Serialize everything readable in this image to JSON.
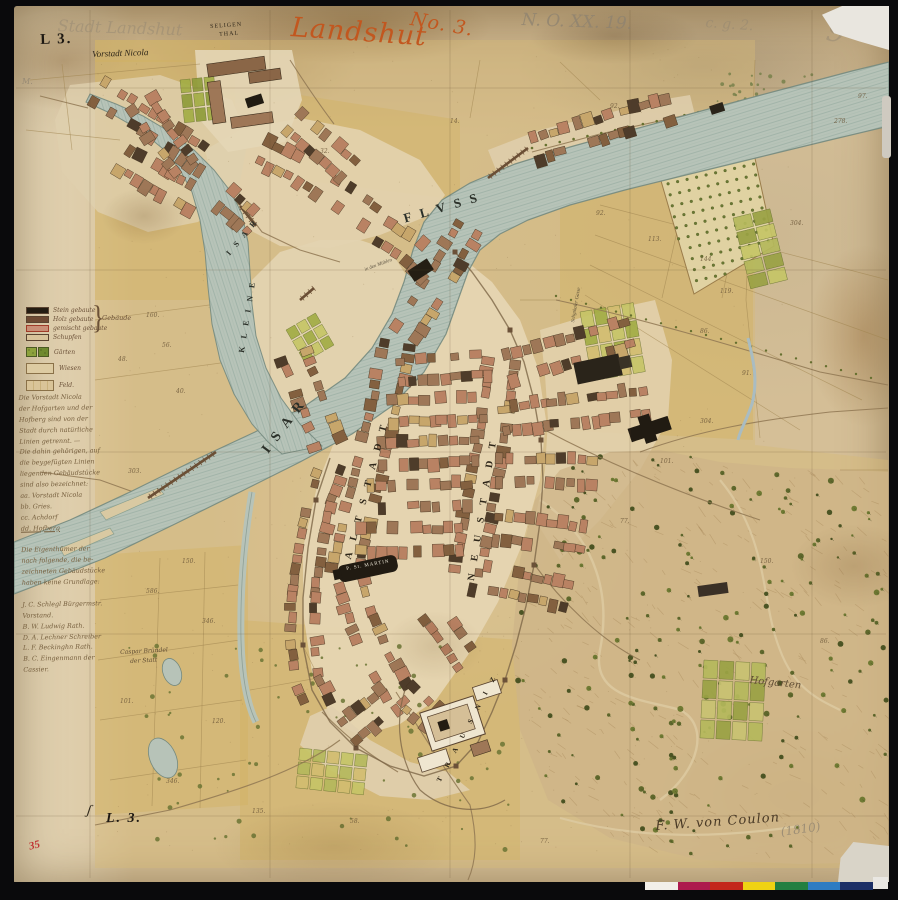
{
  "document": {
    "type": "historic-city-map-scan",
    "title_script": "Landshut",
    "sheet_no": "No. 3.",
    "stamp_top": "L 3.",
    "stamp_bottom": "L. 3.",
    "archive_pencil": "N. O. XX. 19.",
    "pencil_faint_top": "Stadt Landshut",
    "red_margin_number": "35",
    "signature": "F. W. von Coulon",
    "signature_year": "(1810)"
  },
  "labels": [
    {
      "name": "stamp-L3-top",
      "t": "L 3.",
      "x": 40,
      "y": 33,
      "size": 15,
      "rot": -2,
      "cls": "stamp"
    },
    {
      "name": "pencil-stadt-landshut",
      "t": "Stadt Landshut",
      "x": 58,
      "y": 18,
      "size": 16,
      "rot": 2,
      "cls": "pencil faint"
    },
    {
      "name": "red-landshut",
      "t": "Landshut",
      "x": 292,
      "y": 14,
      "size": 27,
      "rot": 4,
      "cls": "redscript"
    },
    {
      "name": "red-no3",
      "t": "No. 3.",
      "x": 412,
      "y": 10,
      "size": 19,
      "rot": 10,
      "cls": "redscript"
    },
    {
      "name": "pencil-archive-no",
      "t": "N. O. XX. 19.",
      "x": 522,
      "y": 12,
      "size": 17,
      "rot": 2,
      "cls": "pencil"
    },
    {
      "name": "pencil-scribble",
      "t": "c. g. 2.",
      "x": 706,
      "y": 16,
      "size": 14,
      "rot": 4,
      "cls": "pencil faint"
    },
    {
      "name": "pencil-flourish",
      "t": "9",
      "x": 830,
      "y": 16,
      "size": 30,
      "rot": 12,
      "cls": "pencil faint"
    },
    {
      "name": "pencil-m",
      "t": "M.",
      "x": 22,
      "y": 78,
      "size": 8,
      "rot": 0,
      "cls": "pencil"
    },
    {
      "name": "vorstadt-nicola-label",
      "t": "Vorstadt Nicola",
      "x": 92,
      "y": 50,
      "size": 9,
      "rot": -2,
      "cls": "inkital"
    },
    {
      "name": "seligenthal-label-1",
      "t": "SELIGEN",
      "x": 210,
      "y": 24,
      "size": 6,
      "rot": -4,
      "cls": "smallcaps"
    },
    {
      "name": "seligenthal-label-2",
      "t": "THAL",
      "x": 219,
      "y": 32,
      "size": 6,
      "rot": -4,
      "cls": "smallcaps"
    },
    {
      "name": "river-label-fluss",
      "t": "F L V S S",
      "x": 402,
      "y": 212,
      "size": 13,
      "rot": -16,
      "cls": "river-label"
    },
    {
      "name": "river-label-isar-main",
      "t": "I S A R",
      "x": 260,
      "y": 448,
      "size": 14,
      "rot": -53,
      "cls": "river-label"
    },
    {
      "name": "river-label-kleine",
      "t": "K L E I N E",
      "x": 238,
      "y": 352,
      "size": 8,
      "rot": -81,
      "cls": "river-label"
    },
    {
      "name": "river-label-isar-small",
      "t": "I S A R",
      "x": 225,
      "y": 252,
      "size": 8,
      "rot": -50,
      "cls": "river-label"
    },
    {
      "name": "street-label-altstadt",
      "t": "A L T S T A D T",
      "x": 344,
      "y": 558,
      "size": 10,
      "rot": -75,
      "cls": "street-label"
    },
    {
      "name": "street-label-neustadt",
      "t": "N E U S T A D T",
      "x": 467,
      "y": 580,
      "size": 10,
      "rot": -81,
      "cls": "street-label"
    },
    {
      "name": "church-label-st-martin",
      "t": "P. St. MARTIN",
      "x": 346,
      "y": 567,
      "size": 5,
      "rot": -10,
      "cls": "church-label"
    },
    {
      "name": "castle-label-trausnitz",
      "t": "T R A U S N I Z",
      "x": 436,
      "y": 780,
      "size": 7,
      "rot": -62,
      "cls": "street-label"
    },
    {
      "name": "hofgarten-label",
      "t": "Hofgarten",
      "x": 750,
      "y": 676,
      "size": 10,
      "rot": 6,
      "cls": "script"
    },
    {
      "name": "gasse-label",
      "t": "Seligthaler Gasse",
      "x": 571,
      "y": 322,
      "size": 5,
      "rot": -80,
      "cls": "tiny-ink"
    },
    {
      "name": "muehlen-label",
      "t": "in den Mühlen",
      "x": 364,
      "y": 268,
      "size": 5,
      "rot": -20,
      "cls": "tiny-ink"
    },
    {
      "name": "owner-note-1",
      "t": "Caspar Bründel",
      "x": 120,
      "y": 650,
      "size": 6,
      "rot": -3,
      "cls": "script"
    },
    {
      "name": "owner-note-2",
      "t": "der Statt",
      "x": 130,
      "y": 659,
      "size": 6,
      "rot": -3,
      "cls": "script"
    },
    {
      "name": "stamp-L3-bottom",
      "t": "L. 3.",
      "x": 106,
      "y": 812,
      "size": 14,
      "rot": 0,
      "cls": "stamp italic"
    },
    {
      "name": "bracket-mark",
      "t": "ʃ",
      "x": 88,
      "y": 804,
      "size": 14,
      "rot": 8,
      "cls": "inkital"
    },
    {
      "name": "red-margin-35",
      "t": "35",
      "x": 28,
      "y": 842,
      "size": 11,
      "rot": -14,
      "cls": "rednum"
    },
    {
      "name": "signature-coulon",
      "t": "F. W. von Coulon",
      "x": 655,
      "y": 820,
      "size": 13,
      "rot": -4,
      "cls": "signature"
    },
    {
      "name": "signature-year",
      "t": "(1810)",
      "x": 780,
      "y": 826,
      "size": 12,
      "rot": -8,
      "cls": "pencil"
    }
  ],
  "legend": {
    "rows": [
      {
        "label": "Stein gebaute",
        "color": "#241c12"
      },
      {
        "label": "Holz gebaute",
        "color": "#6e4a33"
      },
      {
        "label": "gemischt gebaute",
        "color": "#c98f76"
      },
      {
        "label": "Schupfen",
        "color": "#d8c39a"
      }
    ],
    "brace_label": "Gebäude",
    "garden_label": "Gärten",
    "wiesen_label": "Wiesen",
    "feld_label": "Feld."
  },
  "note_lines": [
    {
      "t": "Die Vorstadt Nicola"
    },
    {
      "t": "der Hofgarten und der"
    },
    {
      "t": "Hofberg sind von der"
    },
    {
      "t": "Stadt durch natürliche"
    },
    {
      "t": "Linien getrennt. —"
    },
    {
      "t": "Die dahin gehörigen, auf"
    },
    {
      "t": "die beygefügten Linien"
    },
    {
      "t": "liegenden Gebäudstücke"
    },
    {
      "t": "sind also bezeichnet:"
    },
    {
      "t": "aa. Vorstadt Nicola"
    },
    {
      "t": "bb. Gries."
    },
    {
      "t": "cc. Achdorf"
    },
    {
      "t": "dd. Hofberg",
      "u": true
    },
    {
      "t": ""
    },
    {
      "t": "Die Eigenthümer der"
    },
    {
      "t": "nach folgende, die be-"
    },
    {
      "t": "zeichneten Gebäudstücke"
    },
    {
      "t": "haben keine Grundlage:"
    },
    {
      "t": ""
    },
    {
      "t": "J. C. Schlegl Bürgermstr."
    },
    {
      "t": "Vorstand."
    },
    {
      "t": "B. W. Ludwig Rath."
    },
    {
      "t": "D. A. Lechner Schreiber"
    },
    {
      "t": "L. F. Beckinghn Rath."
    },
    {
      "t": "B. C. Eingenmann der"
    },
    {
      "t": "Cassier."
    }
  ],
  "field_numbers": [
    {
      "x": 146,
      "y": 312,
      "t": "160."
    },
    {
      "x": 118,
      "y": 356,
      "t": "48."
    },
    {
      "x": 162,
      "y": 342,
      "t": "56."
    },
    {
      "x": 176,
      "y": 388,
      "t": "40."
    },
    {
      "x": 128,
      "y": 468,
      "t": "303."
    },
    {
      "x": 182,
      "y": 558,
      "t": "150."
    },
    {
      "x": 146,
      "y": 588,
      "t": "586."
    },
    {
      "x": 202,
      "y": 618,
      "t": "346."
    },
    {
      "x": 120,
      "y": 698,
      "t": "101."
    },
    {
      "x": 212,
      "y": 718,
      "t": "120."
    },
    {
      "x": 166,
      "y": 778,
      "t": "346."
    },
    {
      "x": 252,
      "y": 808,
      "t": "135."
    },
    {
      "x": 596,
      "y": 210,
      "t": "92."
    },
    {
      "x": 648,
      "y": 236,
      "t": "113."
    },
    {
      "x": 700,
      "y": 256,
      "t": "144."
    },
    {
      "x": 720,
      "y": 288,
      "t": "119."
    },
    {
      "x": 700,
      "y": 328,
      "t": "86."
    },
    {
      "x": 790,
      "y": 220,
      "t": "304."
    },
    {
      "x": 742,
      "y": 370,
      "t": "91."
    },
    {
      "x": 700,
      "y": 418,
      "t": "304."
    },
    {
      "x": 660,
      "y": 458,
      "t": "101."
    },
    {
      "x": 620,
      "y": 518,
      "t": "77."
    },
    {
      "x": 760,
      "y": 558,
      "t": "150."
    },
    {
      "x": 820,
      "y": 638,
      "t": "86."
    },
    {
      "x": 320,
      "y": 148,
      "t": "32."
    },
    {
      "x": 450,
      "y": 118,
      "t": "14."
    },
    {
      "x": 610,
      "y": 103,
      "t": "92."
    },
    {
      "x": 834,
      "y": 118,
      "t": "278."
    },
    {
      "x": 858,
      "y": 93,
      "t": "97."
    },
    {
      "x": 350,
      "y": 818,
      "t": "58."
    },
    {
      "x": 540,
      "y": 838,
      "t": "77."
    }
  ],
  "colorbar": {
    "colors": [
      "#f2efe8",
      "#ad1a4d",
      "#c3271b",
      "#efd313",
      "#237f41",
      "#2e7cc2",
      "#1c2f66"
    ]
  },
  "palette": {
    "paper": "#d5bf97",
    "paper_light": "#e7dcc0",
    "river": "#b7c3b8",
    "river_edge": "#74897e",
    "field_ochre": "#d2b25e",
    "garden_green": "#8da23c",
    "building_red": "#b98263",
    "church_black": "#211b12",
    "red_ink": "#c2571f",
    "pencil": "#8d8270"
  }
}
